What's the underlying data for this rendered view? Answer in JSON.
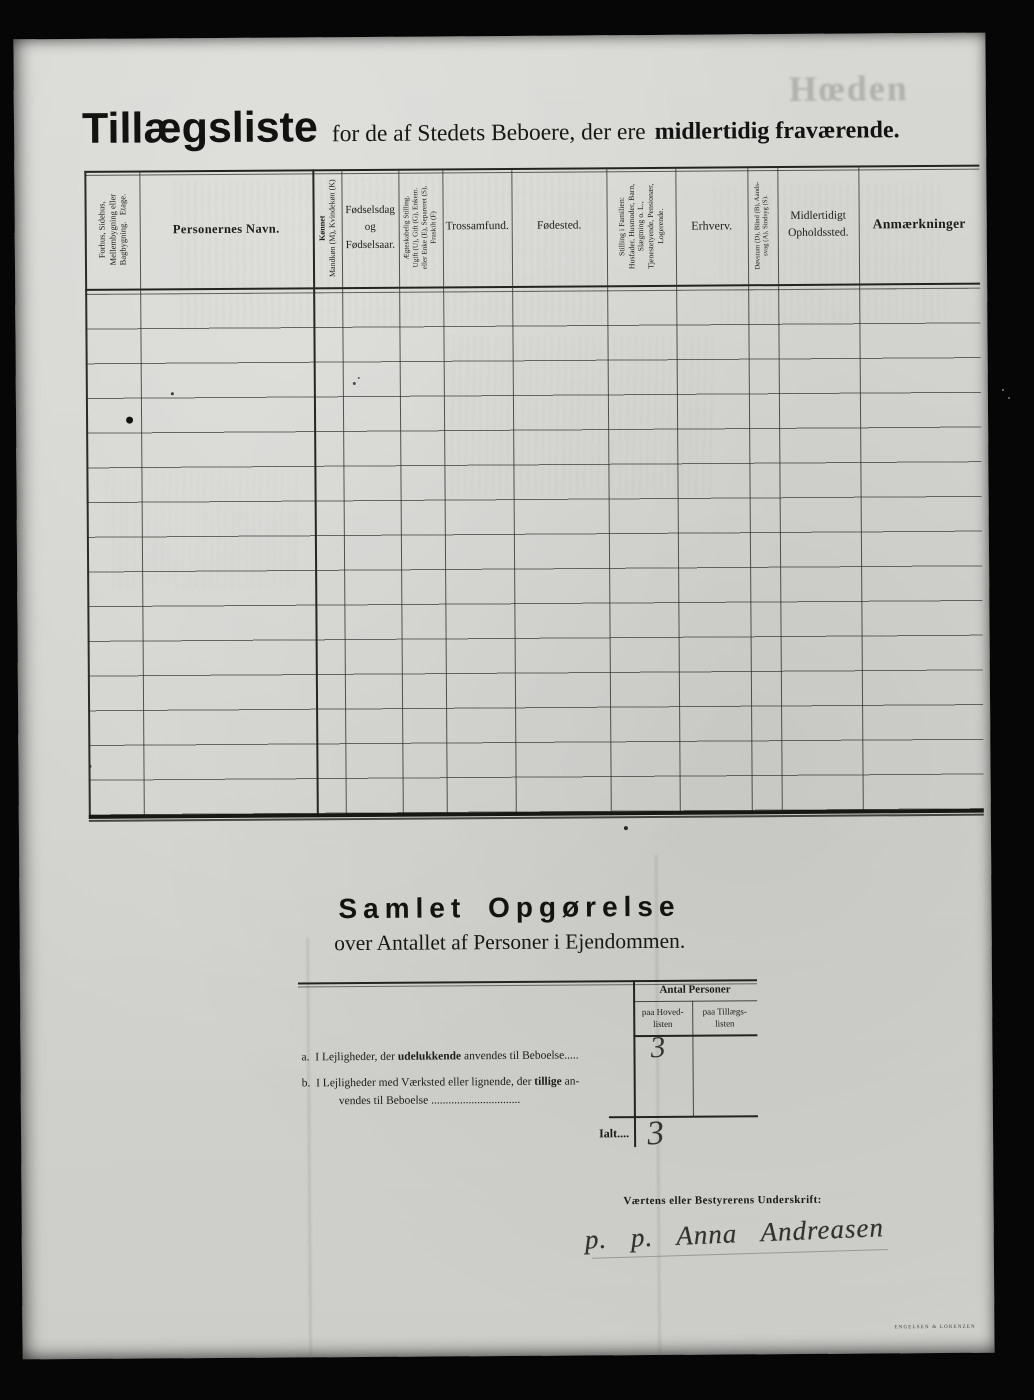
{
  "watermark": "Hœden",
  "page_title": {
    "main": "Tillægsliste",
    "rest": "for de af Stedets Beboere, der ere",
    "rest_bold": "midlertidig fraværende."
  },
  "table": {
    "row_count": 15,
    "entries": [],
    "columns": [
      {
        "id": "building",
        "rotated": true,
        "label_lines": [
          "Forhus, Sidehus,",
          "Mellembygning eller",
          "Bagbygning.   Etage."
        ]
      },
      {
        "id": "name",
        "rotated": false,
        "label": "Personernes Navn."
      },
      {
        "id": "sex",
        "rotated": true,
        "label_lines": [
          "Kønnet",
          "Mandkøn (M), Kvindekøn (K)"
        ]
      },
      {
        "id": "birth",
        "rotated": false,
        "label_lines": [
          "Fødselsdag",
          "og",
          "Fødselsaar."
        ]
      },
      {
        "id": "marital",
        "rotated": true,
        "label_lines": [
          "Ægteskabelig Stilling.",
          "Ugift (U), Gift (G), Enkem.",
          "eller Enke (E), Separeret (S),",
          "Fraskilt (F)"
        ]
      },
      {
        "id": "religion",
        "rotated": false,
        "label": "Trossamfund."
      },
      {
        "id": "birthplace",
        "rotated": false,
        "label": "Fødested."
      },
      {
        "id": "family-position",
        "rotated": true,
        "label_lines": [
          "Stilling i Familien:",
          "Husfader, Husmoder, Barn,",
          "Slægtning o. L.,",
          "Tjenestetyende, Pensionær,",
          "Logerende."
        ]
      },
      {
        "id": "occupation",
        "rotated": false,
        "label": "Erhverv."
      },
      {
        "id": "disability",
        "rotated": true,
        "label_lines": [
          "Døvstum (D), Blind (B), Aands-",
          "svag (A), Sindsyg (S)."
        ]
      },
      {
        "id": "temporary-residence",
        "rotated": false,
        "label_lines": [
          "Midlertidigt",
          "Opholdssted."
        ]
      },
      {
        "id": "remarks",
        "rotated": false,
        "label": "Anmærkninger"
      }
    ]
  },
  "summary": {
    "heading": "Samlet Opgørelse",
    "subheading": "over Antallet af Personer i Ejendommen.",
    "antal_header": "Antal Personer",
    "col_hoved_lines": [
      "paa Hoved-",
      "listen"
    ],
    "col_tillaegs_lines": [
      "paa Tillægs-",
      "listen"
    ],
    "row_a": {
      "index": "a.",
      "pre": "I Lejligheder, der ",
      "bold": "udelukkende",
      "post": " anvendes til Beboelse.....",
      "value_hovedlisten": "3",
      "value_tillaegslisten": ""
    },
    "row_b": {
      "index": "b.",
      "pre": "I Lejligheder med Værksted eller lignende, der ",
      "bold": "tillige",
      "post": " an-",
      "line2": "vendes til Beboelse ...............................",
      "value_hovedlisten": "",
      "value_tillaegslisten": ""
    },
    "total": {
      "label": "Ialt....",
      "value_hovedlisten": "3",
      "value_tillaegslisten": ""
    }
  },
  "signature": {
    "label": "Værtens eller Bestyrerens Underskrift:",
    "name": "p. p.  Anna  Andreasen"
  },
  "printer_mark": "Engelsen & Lorenzen"
}
